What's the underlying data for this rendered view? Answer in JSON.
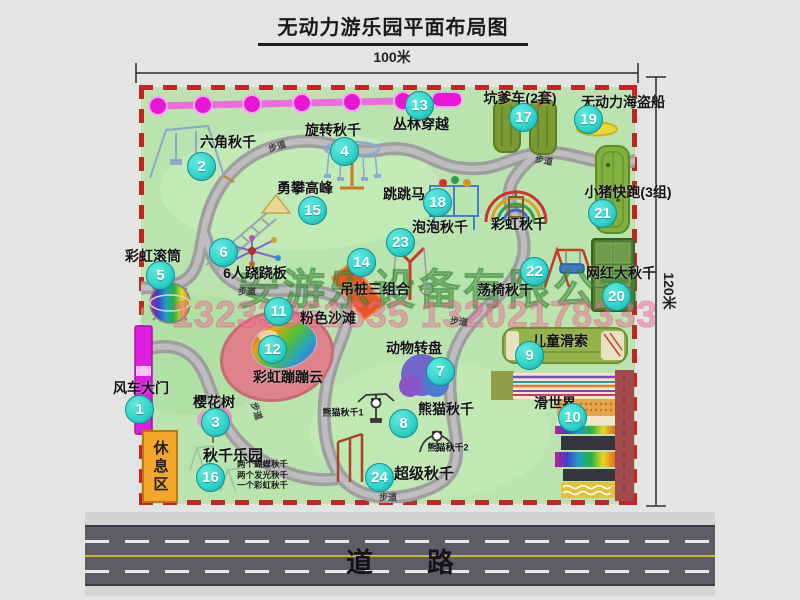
{
  "title": "无动力游乐园平面布局图",
  "dimensions": {
    "width_label": "100米",
    "height_label": "120米"
  },
  "road": {
    "label": "道　　路"
  },
  "rest_area": {
    "label": "休息区"
  },
  "watermark": {
    "company": "安游乐设备有限公司",
    "phones": "13233861635 13202178333"
  },
  "path_label": "步道",
  "walkway_labels": [
    {
      "x": 277,
      "y": 146,
      "rot": -18
    },
    {
      "x": 544,
      "y": 160,
      "rot": 10
    },
    {
      "x": 247,
      "y": 291,
      "rot": 0
    },
    {
      "x": 459,
      "y": 321,
      "rot": 6
    },
    {
      "x": 388,
      "y": 497,
      "rot": 0
    },
    {
      "x": 257,
      "y": 411,
      "rot": 72
    }
  ],
  "attractions": [
    {
      "num": 1,
      "label": "风车大门",
      "bx": 139,
      "by": 409,
      "lx": 141,
      "ly": 388
    },
    {
      "num": 2,
      "label": "六角秋千",
      "bx": 201,
      "by": 166,
      "lx": 228,
      "ly": 142
    },
    {
      "num": 3,
      "label": "樱花树",
      "bx": 215,
      "by": 422,
      "lx": 214,
      "ly": 402
    },
    {
      "num": 4,
      "label": "旋转秋千",
      "bx": 344,
      "by": 151,
      "lx": 333,
      "ly": 130
    },
    {
      "num": 5,
      "label": "彩虹滚筒",
      "bx": 160,
      "by": 275,
      "lx": 153,
      "ly": 256
    },
    {
      "num": 6,
      "label": "6人跷跷板",
      "bx": 223,
      "by": 252,
      "lx": 255,
      "ly": 273
    },
    {
      "num": 7,
      "label": "动物转盘",
      "bx": 440,
      "by": 371,
      "lx": 414,
      "ly": 348
    },
    {
      "num": 8,
      "label": "熊猫秋千",
      "bx": 403,
      "by": 423,
      "lx": 446,
      "ly": 409
    },
    {
      "num": 9,
      "label": "儿童滑索",
      "bx": 529,
      "by": 355,
      "lx": 560,
      "ly": 341
    },
    {
      "num": 10,
      "label": "滑世界",
      "bx": 572,
      "by": 417,
      "lx": 555,
      "ly": 403
    },
    {
      "num": 11,
      "label": "粉色沙滩",
      "bx": 278,
      "by": 311,
      "lx": 328,
      "ly": 318
    },
    {
      "num": 12,
      "label": "彩虹蹦蹦云",
      "bx": 272,
      "by": 349,
      "lx": 288,
      "ly": 377
    },
    {
      "num": 13,
      "label": "丛林穿越",
      "bx": 419,
      "by": 105,
      "lx": 421,
      "ly": 124
    },
    {
      "num": 14,
      "label": "吊桩三组合",
      "bx": 361,
      "by": 262,
      "lx": 375,
      "ly": 289
    },
    {
      "num": 15,
      "label": "勇攀高峰",
      "bx": 312,
      "by": 210,
      "lx": 305,
      "ly": 188
    },
    {
      "num": 16,
      "label": "秋千乐园",
      "bx": 210,
      "by": 477,
      "lx": 233,
      "ly": 455,
      "ls": 15
    },
    {
      "num": 17,
      "label": "坑爹车(2套)",
      "bx": 523,
      "by": 117,
      "lx": 520,
      "ly": 98
    },
    {
      "num": 18,
      "label": "跳跳马",
      "bx": 437,
      "by": 202,
      "lx": 404,
      "ly": 194
    },
    {
      "num": 19,
      "label": "无动力海盗船",
      "bx": 588,
      "by": 119,
      "lx": 623,
      "ly": 102
    },
    {
      "num": 20,
      "label": "网红大秋千",
      "bx": 616,
      "by": 296,
      "lx": 621,
      "ly": 273
    },
    {
      "num": 21,
      "label": "小猪快跑(3组)",
      "bx": 602,
      "by": 213,
      "lx": 628,
      "ly": 192
    },
    {
      "num": 22,
      "label": "荡椅秋千",
      "bx": 534,
      "by": 271,
      "lx": 505,
      "ly": 290
    },
    {
      "num": 23,
      "label": "泡泡秋千",
      "bx": 400,
      "by": 242,
      "lx": 440,
      "ly": 227
    },
    {
      "num": 24,
      "label": "超级秋千",
      "bx": 379,
      "by": 477,
      "lx": 424,
      "ly": 473,
      "ls": 15
    }
  ],
  "extra_labels": [
    {
      "text": "彩虹秋千",
      "x": 519,
      "y": 224,
      "size": 14
    },
    {
      "text": "熊猫秋千1",
      "x": 343,
      "y": 412,
      "size": 9
    },
    {
      "text": "熊猫秋千2",
      "x": 448,
      "y": 447,
      "size": 9
    }
  ],
  "swing_park_details": [
    "两个蝴蝶秋千",
    "两个发光秋千",
    "一个彩虹秋千"
  ],
  "colors": {
    "badge": "#2fd3c9",
    "map_green": "#b9e4ae",
    "border_red": "#c32424",
    "road_gray": "#5d5d65",
    "road_yellow": "#c9b23b",
    "chain_magenta": "#e916d6",
    "gate_magenta": "#df1fdf",
    "rest_area_orange": "#f5a528"
  }
}
